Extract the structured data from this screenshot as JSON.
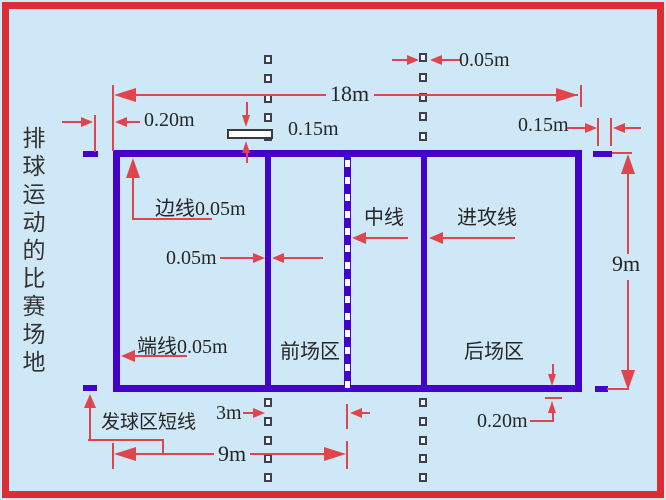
{
  "colors": {
    "background": "#cfe8f7",
    "frame_red": "#dd2d33",
    "court_purple": "#4503ca",
    "dimension_red": "#e0444c",
    "text_dark": "#262626"
  },
  "title_vertical": "排球运动的比赛场地",
  "labels": {
    "sideline": "边线0.05m",
    "endline": "端线0.05m",
    "center_line": "中线",
    "attack_line": "进攻线",
    "front_zone": "前场区",
    "back_zone": "后场区",
    "service_short_line": "发球区短线"
  },
  "dimensions": {
    "court_length": "18m",
    "half_court_length": "9m",
    "court_width": "9m",
    "attack_line_distance": "3m",
    "line_width_top": "0.05m",
    "attack_line_width": "0.05m",
    "service_mark_offset_left": "0.20m",
    "service_mark_offset_bottom": "0.20m",
    "dash_length_mid": "0.15m",
    "service_mark_length_right": "0.15m"
  }
}
